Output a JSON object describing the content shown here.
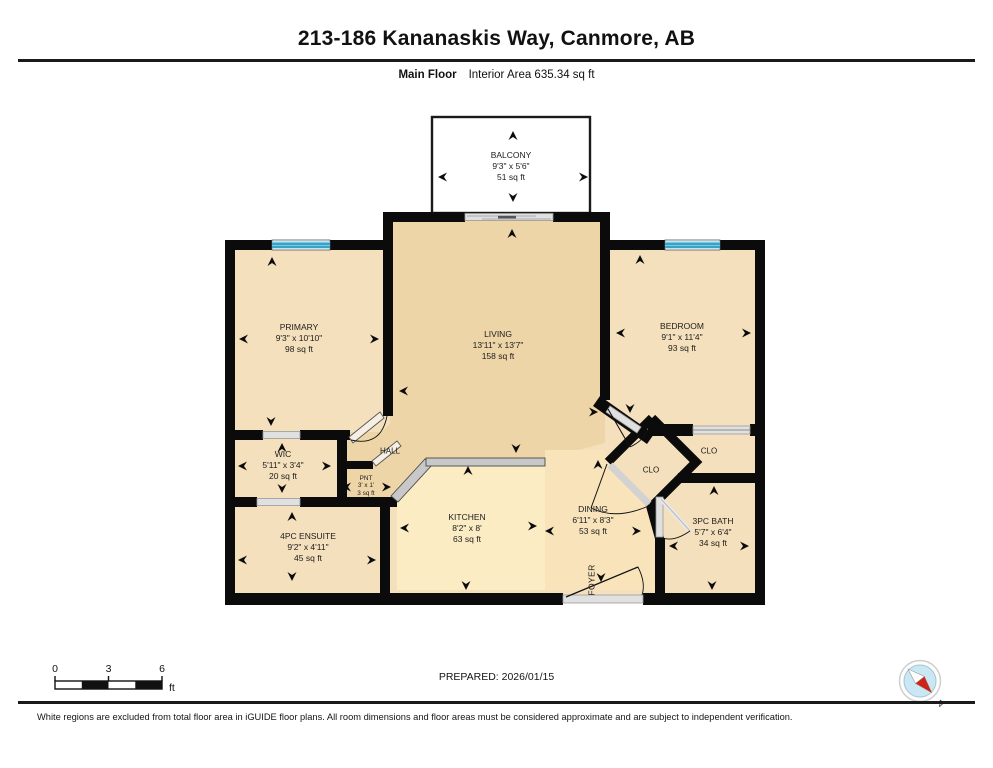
{
  "header": {
    "title": "213-186 Kananaskis Way, Canmore, AB",
    "floor_label": "Main Floor",
    "interior_area_label": "Interior Area 635.34 sq ft"
  },
  "rooms": {
    "balcony": {
      "name": "BALCONY",
      "dims": "9'3\" x 5'6\"",
      "area": "51 sq ft"
    },
    "primary": {
      "name": "PRIMARY",
      "dims": "9'3\" x 10'10\"",
      "area": "98 sq ft"
    },
    "living": {
      "name": "LIVING",
      "dims": "13'11\" x 13'7\"",
      "area": "158 sq ft"
    },
    "bedroom": {
      "name": "BEDROOM",
      "dims": "9'1\" x 11'4\"",
      "area": "93 sq ft"
    },
    "wic": {
      "name": "WIC",
      "dims": "5'11\" x 3'4\"",
      "area": "20 sq ft"
    },
    "hall": {
      "name": "HALL"
    },
    "pantry": {
      "name": "PNT",
      "dims": "3' x 1'",
      "area": "3 sq ft"
    },
    "kitchen": {
      "name": "KITCHEN",
      "dims": "8'2\" x 8'",
      "area": "63 sq ft"
    },
    "dining": {
      "name": "DINING",
      "dims": "6'11\" x 8'3\"",
      "area": "53 sq ft"
    },
    "foyer": {
      "name": "FOYER"
    },
    "ensuite": {
      "name": "4PC ENSUITE",
      "dims": "9'2\" x 4'11\"",
      "area": "45 sq ft"
    },
    "bath": {
      "name": "3PC BATH",
      "dims": "5'7\" x 6'4\"",
      "area": "34 sq ft"
    },
    "closet_hall": {
      "name": "CLO"
    },
    "closet_bedroom": {
      "name": "CLO"
    }
  },
  "footer": {
    "scale": {
      "tick0": "0",
      "tick3": "3",
      "tick6": "6",
      "unit": "ft"
    },
    "prepared": "PREPARED: 2026/01/15",
    "compass_north": "N",
    "disclaimer": "White regions are excluded from total floor area in iGUIDE floor plans. All room dimensions and floor areas must be considered approximate and are subject to independent verification."
  },
  "colors": {
    "wall": "#0b0b0b",
    "room_tan": "#f5e0bd",
    "living_tan": "#eed5a8",
    "kitchen_cream": "#fbecc4",
    "dining_tan": "#f8e3bb",
    "window_blue": "#74cdea",
    "window_line_blue": "#1b84ad",
    "door_gray": "#e0e0e0",
    "railing_gray": "#c8c8c8",
    "compass_red": "#cc2418",
    "compass_blue": "#cae7f4"
  }
}
